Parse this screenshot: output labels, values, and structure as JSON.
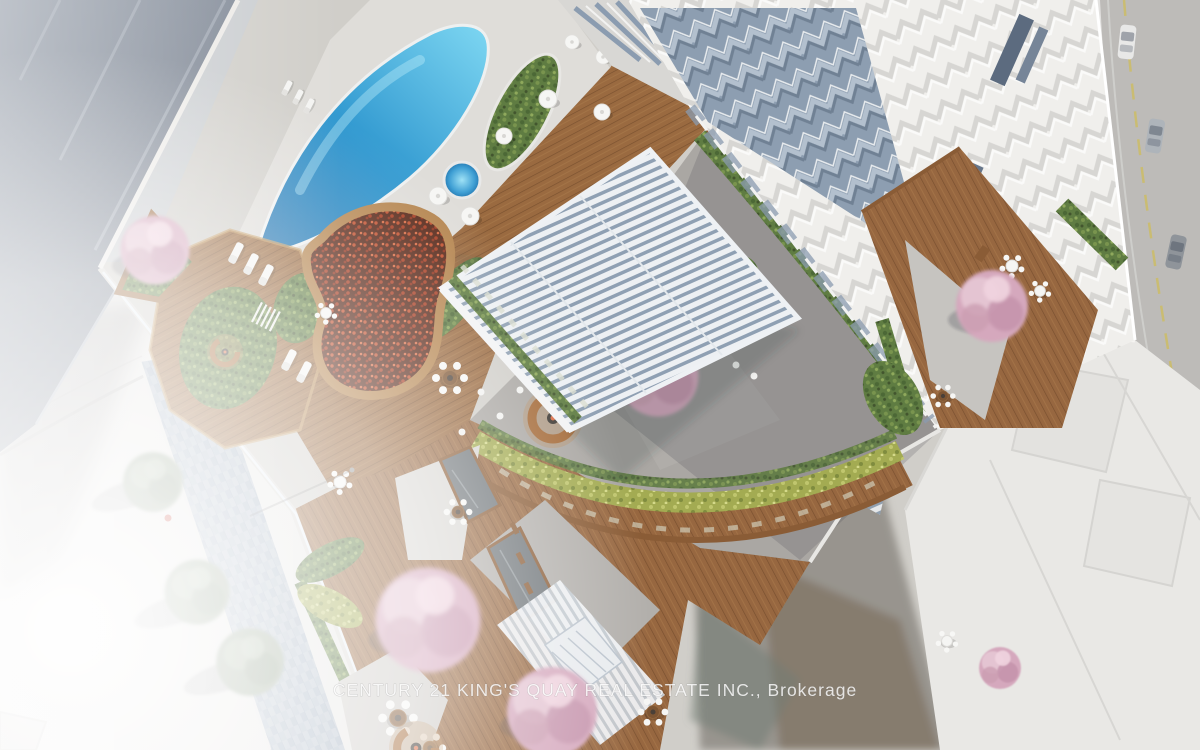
{
  "image": {
    "type": "aerial architectural rendering",
    "subject": "bird's-eye view of a condominium podium rooftop amenity terrace between towers, with curved outdoor pool, hot tub, red flower garden, wood decks, louvered canopy, cherry blossom trees, lounge and dining areas, bordered by city streets",
    "watermark": "CENTURY 21 KING'S QUAY REAL ESTATE INC., Brokerage"
  },
  "scene_elements": [
    "curved swimming pool",
    "circular hot tub",
    "sun loungers",
    "umbrella tables",
    "red flower garden bed",
    "green garden beds",
    "louvered white canopy roof",
    "residential tower with chevron balconies",
    "central courtyard with fire-pit lounges",
    "cherry blossom trees",
    "street trees",
    "sidewalk with pavers",
    "city streets with cars",
    "neighbouring rooftops",
    "pergola slats",
    "glass skylights",
    "dining sets",
    "hedge planters"
  ],
  "palette": {
    "street": "#e7e6e4",
    "asphalt": "#bdbbb8",
    "concrete": "#d0cec9",
    "deckWhite": "#dfddd9",
    "courtyard": "#aaa7a3",
    "towerWhite": "#f0efec",
    "roofSlate": "#7d8592",
    "wood": "#9a6a40",
    "woodDark": "#7a5130",
    "woodLight": "#c59a5f",
    "greenDark": "#4c6836",
    "green": "#5f7c42",
    "yellowGreen": "#a3ab52",
    "blossom": "#d5a8bd",
    "blossomLight": "#e6c6d4",
    "glass": "#8093a9",
    "louver": "#edf0f3",
    "poolDeep": "#1d6fae",
    "poolMid": "#2f97cf",
    "poolLight": "#7ed7f2",
    "watermark": "rgba(255,255,255,0.8)"
  }
}
